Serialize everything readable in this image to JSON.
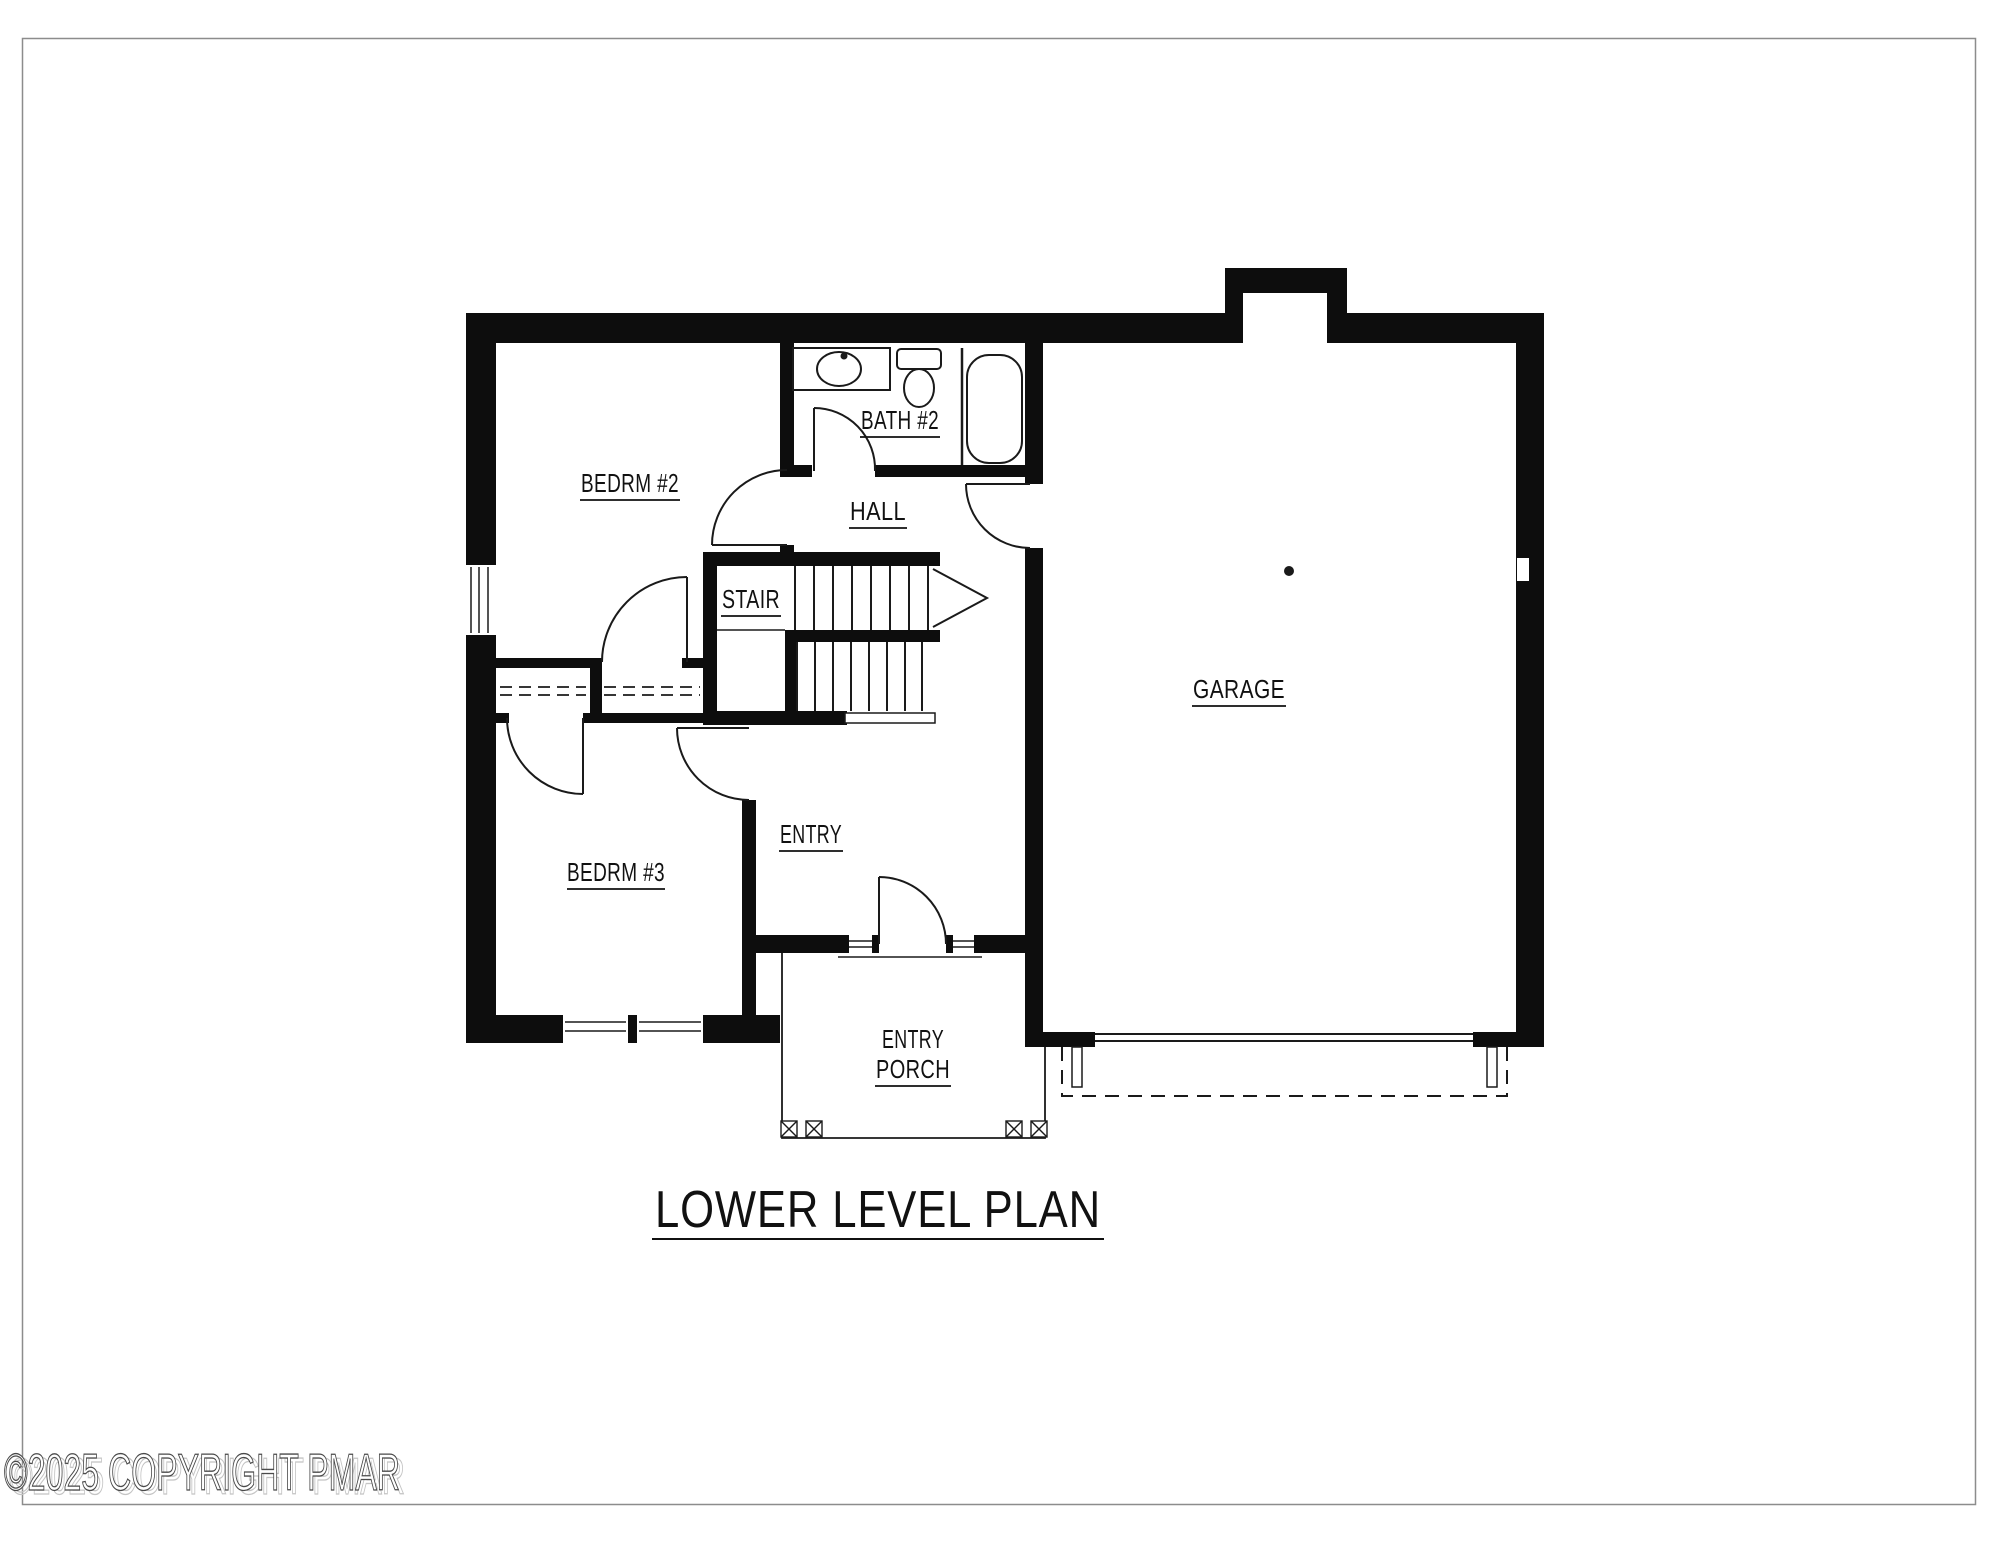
{
  "title": {
    "text": "LOWER LEVEL PLAN"
  },
  "copyright": {
    "text": "©2025 COPYRIGHT PMAR"
  },
  "colors": {
    "wall": "#0d0d0d",
    "line": "#1a1a1a",
    "frame": "#8c8c8c",
    "background": "#ffffff"
  },
  "rooms": {
    "bedrm2": {
      "label": "BEDRM #2"
    },
    "bath2": {
      "label": "BATH #2"
    },
    "hall": {
      "label": "HALL"
    },
    "stair": {
      "label": "STAIR"
    },
    "garage": {
      "label": "GARAGE"
    },
    "bedrm3": {
      "label": "BEDRM #3"
    },
    "entry": {
      "label": "ENTRY"
    },
    "entry_porch": {
      "label_line1": "ENTRY",
      "label_line2": "PORCH"
    }
  }
}
